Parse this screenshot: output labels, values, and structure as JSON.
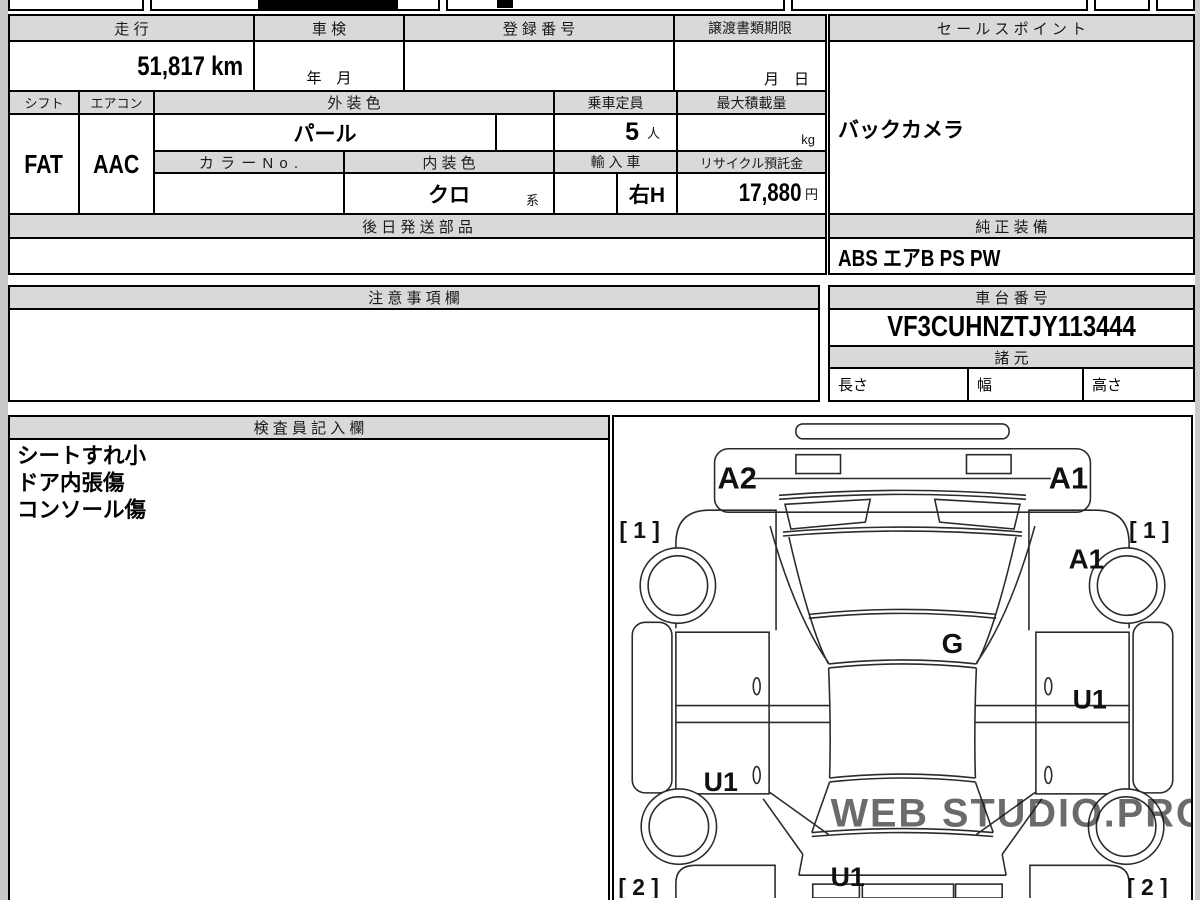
{
  "vehicle_table": {
    "mileage": {
      "label": "走 行",
      "value": "51,817 km"
    },
    "inspection": {
      "label": "車 検",
      "value": "年　月"
    },
    "registration": {
      "label": "登 録 番 号",
      "value": ""
    },
    "transfer_deadline": {
      "label": "譲渡書類期限",
      "value": "月　日"
    },
    "shift": {
      "label": "シフト",
      "value": "FAT"
    },
    "aircon": {
      "label": "エアコン",
      "value": "AAC"
    },
    "exterior_color": {
      "label": "外 装 色",
      "value": "パール"
    },
    "capacity": {
      "label": "乗車定員",
      "value": "5",
      "unit": "人"
    },
    "max_load": {
      "label": "最大積載量",
      "value": "",
      "unit": "kg"
    },
    "color_no": {
      "label": "カ ラ ー N o .",
      "value": ""
    },
    "interior_color": {
      "label": "内 装 色",
      "value": "クロ",
      "suffix": "系"
    },
    "import_car": {
      "label": "輸 入 車",
      "value": "右H"
    },
    "recycle_deposit": {
      "label": "リサイクル預託金",
      "value": "17,880",
      "unit": "円"
    },
    "later_parts": {
      "label": "後 日 発 送 部 品",
      "value": ""
    }
  },
  "sales_point": {
    "label": "セ ー ル ス ポ イ ン ト",
    "value": "バックカメラ"
  },
  "genuine_equipment": {
    "label": "純 正 装 備",
    "value": "ABS エアB PS PW"
  },
  "caution": {
    "label": "注 意 事 項 欄",
    "value": ""
  },
  "chassis": {
    "label": "車 台 番 号",
    "value": "VF3CUHNZTJY113444"
  },
  "specs": {
    "label": "諸 元",
    "length_label": "長さ",
    "length_value": "",
    "width_label": "幅",
    "width_value": "",
    "height_label": "高さ",
    "height_value": ""
  },
  "inspector_notes": {
    "label": "検 査 員 記 入 欄",
    "lines": [
      "シートすれ小",
      "ドア内張傷",
      "コンソール傷"
    ]
  },
  "diagram": {
    "bumper_left": "A2",
    "bumper_right": "A1",
    "corner_top_left": "[ 1 ]",
    "corner_top_right": "[ 1 ]",
    "fender_right": "A1",
    "glass": "G",
    "door_right": "U1",
    "door_left": "U1",
    "rear_center": "U1",
    "corner_bottom_left": "[ 2 ]",
    "corner_bottom_right": "[ 2 ]",
    "watermark": "WEB STUDIO.PRO"
  },
  "colors": {
    "header_bg": "#d9d9d9",
    "line": "#000000",
    "watermark": "#cfcfcf"
  }
}
